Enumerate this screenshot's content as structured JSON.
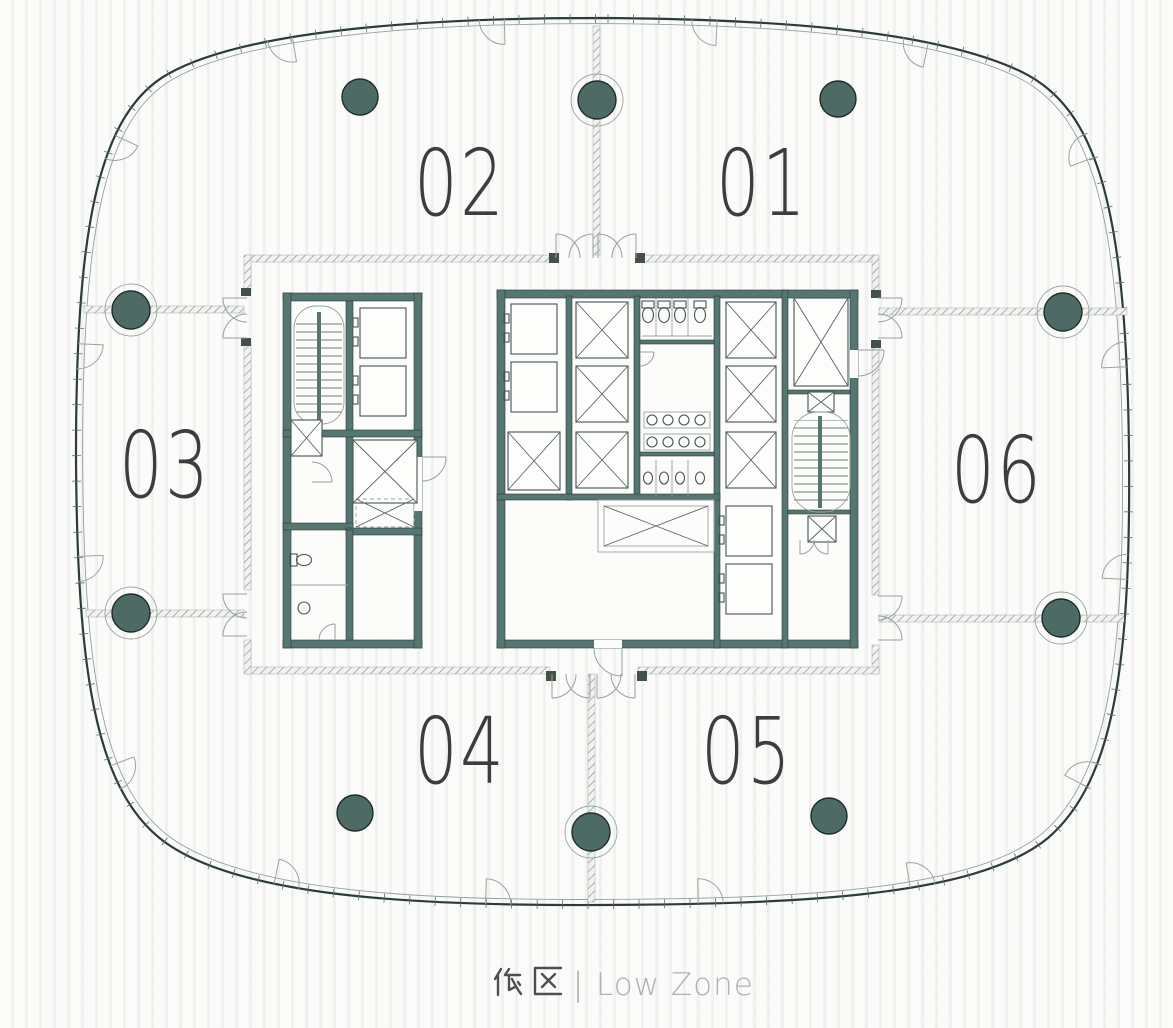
{
  "floor_plan": {
    "caption": {
      "zh": "低 区",
      "divider": "|",
      "en": "Low Zone"
    },
    "units": {
      "u01": {
        "label": "01"
      },
      "u02": {
        "label": "02"
      },
      "u03": {
        "label": "03"
      },
      "u04": {
        "label": "04"
      },
      "u05": {
        "label": "05"
      },
      "u06": {
        "label": "06"
      }
    },
    "structure": {
      "columns_total": 10,
      "gridline_columns": 6,
      "field_columns": 4,
      "core_blocks": [
        "west-core",
        "central-core"
      ],
      "symbols": [
        "stair",
        "elevator-car",
        "shaft-x",
        "wc",
        "urinal",
        "sink",
        "door-swing",
        "facade-mullion-tick",
        "window-swing-arc",
        "demising-wall-hatch"
      ]
    },
    "colors": {
      "wall": "#567671",
      "column": "#4d6a64",
      "envelope_line": "#2d3c38",
      "hatch_line": "#8b958f",
      "unit_label": "#3d3d3d",
      "caption_zh": "#4f4f4f",
      "caption_en": "#b1b1b1",
      "background": "#f6f7f5"
    }
  }
}
